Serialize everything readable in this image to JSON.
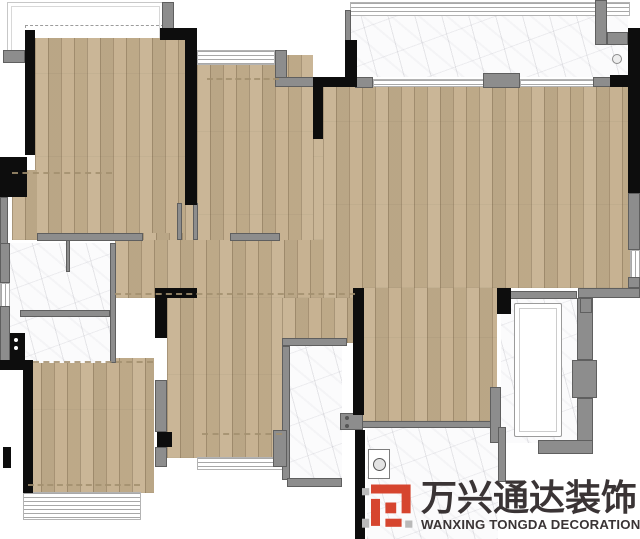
{
  "title": "apartment-floor-plan",
  "colors": {
    "wood": "#c5b08e",
    "marble": "#fbfbfc",
    "wall_black": "#0d0d0d",
    "wall_gray": "#8d8d8d",
    "dashed_line": "#a3906f",
    "logo_red": "#d6452f",
    "logo_gray": "#b9b9b9",
    "logo_text": "#3a3435"
  },
  "floorplan": {
    "outlines": [
      {
        "n": "balcony-outline-top-left",
        "x": 7,
        "y": 2,
        "w": 155,
        "h": 56
      },
      {
        "n": "balcony-dashed-zone",
        "x": 25,
        "y": 25,
        "w": 137,
        "h": 31,
        "dashed": true
      }
    ],
    "floors": [
      {
        "n": "bedroom-top-left-floor",
        "t": "wood",
        "x": 35,
        "y": 38,
        "w": 153,
        "h": 202
      },
      {
        "n": "bedroom-top-left-extension-floor",
        "t": "wood",
        "x": 12,
        "y": 170,
        "w": 25,
        "h": 70
      },
      {
        "n": "entry-dining-floor",
        "t": "wood",
        "x": 197,
        "y": 55,
        "w": 116,
        "h": 243
      },
      {
        "n": "entry-door-floor-patch",
        "t": "wood",
        "x": 185,
        "y": 205,
        "w": 12,
        "h": 36
      },
      {
        "n": "corridor-door-floor-patch",
        "t": "wood",
        "x": 143,
        "y": 233,
        "w": 42,
        "h": 12
      },
      {
        "n": "living-room-floor",
        "t": "wood",
        "x": 323,
        "y": 87,
        "w": 307,
        "h": 201
      },
      {
        "n": "living-room-floor-patch",
        "t": "wood",
        "x": 313,
        "y": 139,
        "w": 10,
        "h": 101
      },
      {
        "n": "corridor-floor",
        "t": "wood",
        "x": 115,
        "y": 240,
        "w": 247,
        "h": 58
      },
      {
        "n": "hallway-bath-floor",
        "t": "wood",
        "x": 282,
        "y": 298,
        "w": 80,
        "h": 45
      },
      {
        "n": "bottom-left-room-floor",
        "t": "wood",
        "x": 28,
        "y": 358,
        "w": 126,
        "h": 135
      },
      {
        "n": "bedroom-bottom-middle-floor",
        "t": "wood",
        "x": 167,
        "y": 298,
        "w": 115,
        "h": 160
      },
      {
        "n": "bedroom-bottom-right-floor",
        "t": "wood",
        "x": 362,
        "y": 288,
        "w": 135,
        "h": 133
      },
      {
        "n": "balcony-top-right-floor",
        "t": "marble",
        "x": 350,
        "y": 8,
        "w": 278,
        "h": 69
      },
      {
        "n": "bathroom-left-floor",
        "t": "marble",
        "x": 10,
        "y": 243,
        "w": 100,
        "h": 120
      },
      {
        "n": "bathroom-middle-floor",
        "t": "marble",
        "x": 287,
        "y": 343,
        "w": 55,
        "h": 137
      },
      {
        "n": "bathroom-right-floor",
        "t": "marble",
        "x": 501,
        "y": 295,
        "w": 76,
        "h": 148
      },
      {
        "n": "kitchen-floor",
        "t": "marble",
        "x": 367,
        "y": 427,
        "w": 131,
        "h": 112
      }
    ],
    "windows": [
      {
        "n": "balcony-top-rail",
        "o": "h",
        "x": 350,
        "y": 2,
        "w": 278,
        "h": 12
      },
      {
        "n": "entry-sill",
        "o": "h",
        "x": 197,
        "y": 50,
        "w": 76,
        "h": 13
      },
      {
        "n": "sliding-door-track-left",
        "o": "h",
        "x": 373,
        "y": 79,
        "w": 110,
        "h": 6
      },
      {
        "n": "sliding-door-track-right",
        "o": "h",
        "x": 520,
        "y": 79,
        "w": 73,
        "h": 6
      },
      {
        "n": "bathroom-left-window",
        "o": "v",
        "x": 0,
        "y": 283,
        "w": 8,
        "h": 23
      },
      {
        "n": "bottom-left-window",
        "o": "h",
        "x": 23,
        "y": 492,
        "w": 116,
        "h": 26
      },
      {
        "n": "bedroom-bottom-window",
        "o": "h",
        "x": 197,
        "y": 457,
        "w": 90,
        "h": 11
      },
      {
        "n": "right-wall-window",
        "o": "v",
        "x": 630,
        "y": 250,
        "w": 10,
        "h": 27
      }
    ],
    "walls_gray": [
      {
        "x": 162,
        "y": 2,
        "w": 12,
        "h": 30
      },
      {
        "x": 3,
        "y": 50,
        "w": 22,
        "h": 13
      },
      {
        "x": 275,
        "y": 50,
        "w": 12,
        "h": 37
      },
      {
        "x": 275,
        "y": 77,
        "w": 40,
        "h": 10
      },
      {
        "x": 355,
        "y": 77,
        "w": 18,
        "h": 11
      },
      {
        "x": 483,
        "y": 73,
        "w": 37,
        "h": 15
      },
      {
        "x": 593,
        "y": 77,
        "w": 22,
        "h": 10
      },
      {
        "x": 595,
        "y": 0,
        "w": 12,
        "h": 45
      },
      {
        "x": 607,
        "y": 32,
        "w": 21,
        "h": 13
      },
      {
        "x": 628,
        "y": 32,
        "w": 12,
        "h": 45
      },
      {
        "x": 345,
        "y": 10,
        "w": 6,
        "h": 67
      },
      {
        "x": 0,
        "y": 197,
        "w": 8,
        "h": 73
      },
      {
        "x": 0,
        "y": 243,
        "w": 10,
        "h": 40
      },
      {
        "x": 0,
        "y": 306,
        "w": 10,
        "h": 57
      },
      {
        "x": 37,
        "y": 233,
        "w": 106,
        "h": 8
      },
      {
        "x": 230,
        "y": 233,
        "w": 50,
        "h": 8
      },
      {
        "x": 20,
        "y": 310,
        "w": 90,
        "h": 7
      },
      {
        "x": 110,
        "y": 243,
        "w": 6,
        "h": 120
      },
      {
        "x": 66,
        "y": 240,
        "w": 4,
        "h": 32
      },
      {
        "x": 177,
        "y": 203,
        "w": 5,
        "h": 37
      },
      {
        "x": 193,
        "y": 203,
        "w": 5,
        "h": 37
      },
      {
        "x": 282,
        "y": 338,
        "w": 65,
        "h": 8
      },
      {
        "x": 282,
        "y": 346,
        "w": 8,
        "h": 134
      },
      {
        "x": 287,
        "y": 478,
        "w": 55,
        "h": 9
      },
      {
        "x": 340,
        "y": 413,
        "w": 23,
        "h": 17
      },
      {
        "x": 362,
        "y": 421,
        "w": 131,
        "h": 7
      },
      {
        "x": 490,
        "y": 387,
        "w": 11,
        "h": 56
      },
      {
        "x": 500,
        "y": 291,
        "w": 77,
        "h": 8
      },
      {
        "x": 577,
        "y": 298,
        "w": 16,
        "h": 62
      },
      {
        "x": 572,
        "y": 360,
        "w": 25,
        "h": 38
      },
      {
        "x": 577,
        "y": 398,
        "w": 16,
        "h": 45
      },
      {
        "x": 538,
        "y": 440,
        "w": 55,
        "h": 14
      },
      {
        "x": 578,
        "y": 288,
        "w": 62,
        "h": 10
      },
      {
        "x": 628,
        "y": 193,
        "w": 12,
        "h": 57
      },
      {
        "x": 628,
        "y": 277,
        "w": 12,
        "h": 11
      },
      {
        "x": 580,
        "y": 298,
        "w": 12,
        "h": 15
      },
      {
        "x": 498,
        "y": 427,
        "w": 8,
        "h": 55
      },
      {
        "x": 155,
        "y": 380,
        "w": 12,
        "h": 52
      },
      {
        "x": 155,
        "y": 447,
        "w": 12,
        "h": 20
      },
      {
        "x": 273,
        "y": 430,
        "w": 14,
        "h": 37
      }
    ],
    "walls_black": [
      {
        "x": 160,
        "y": 28,
        "w": 35,
        "h": 12
      },
      {
        "x": 185,
        "y": 28,
        "w": 12,
        "h": 177
      },
      {
        "x": 25,
        "y": 30,
        "w": 10,
        "h": 125
      },
      {
        "x": 0,
        "y": 157,
        "w": 27,
        "h": 40
      },
      {
        "x": 345,
        "y": 40,
        "w": 12,
        "h": 40
      },
      {
        "x": 313,
        "y": 77,
        "w": 44,
        "h": 10
      },
      {
        "x": 313,
        "y": 87,
        "w": 10,
        "h": 52
      },
      {
        "x": 610,
        "y": 75,
        "w": 30,
        "h": 12
      },
      {
        "x": 628,
        "y": 28,
        "w": 12,
        "h": 49
      },
      {
        "x": 628,
        "y": 87,
        "w": 12,
        "h": 106
      },
      {
        "x": 155,
        "y": 288,
        "w": 42,
        "h": 10
      },
      {
        "x": 155,
        "y": 298,
        "w": 12,
        "h": 40
      },
      {
        "x": 353,
        "y": 288,
        "w": 11,
        "h": 127
      },
      {
        "x": 355,
        "y": 450,
        "w": 10,
        "h": 29
      },
      {
        "x": 497,
        "y": 288,
        "w": 14,
        "h": 26
      },
      {
        "x": 23,
        "y": 360,
        "w": 10,
        "h": 133
      },
      {
        "x": 0,
        "y": 360,
        "w": 23,
        "h": 10
      },
      {
        "x": 157,
        "y": 432,
        "w": 15,
        "h": 15
      },
      {
        "x": 355,
        "y": 430,
        "w": 10,
        "h": 109
      },
      {
        "x": 3,
        "y": 447,
        "w": 8,
        "h": 21
      },
      {
        "x": 10,
        "y": 333,
        "w": 15,
        "h": 30
      }
    ],
    "dashed": [
      {
        "x": 12,
        "y": 172,
        "w": 100
      },
      {
        "x": 207,
        "y": 78,
        "w": 72
      },
      {
        "x": 115,
        "y": 293,
        "w": 240
      },
      {
        "x": 33,
        "y": 361,
        "w": 120
      },
      {
        "x": 28,
        "y": 484,
        "w": 112
      },
      {
        "x": 202,
        "y": 433,
        "w": 80
      }
    ],
    "fixtures": [
      {
        "kind": "tub",
        "x": 514,
        "y": 303,
        "w": 46,
        "h": 132
      },
      {
        "kind": "washer",
        "x": 368,
        "y": 449,
        "w": 20,
        "h": 28
      },
      {
        "kind": "sink-dots",
        "x": 13,
        "y": 338,
        "w": 8,
        "h": 16,
        "dot": "#ffffff"
      },
      {
        "kind": "vanity-dots",
        "x": 344,
        "y": 416,
        "w": 6,
        "h": 13,
        "dot": "#555555"
      },
      {
        "kind": "drain",
        "x": 612,
        "y": 54,
        "w": 8,
        "h": 8
      }
    ]
  },
  "logo": {
    "cn": "万兴通达装饰",
    "en": "WANXING TONGDA DECORATION"
  }
}
